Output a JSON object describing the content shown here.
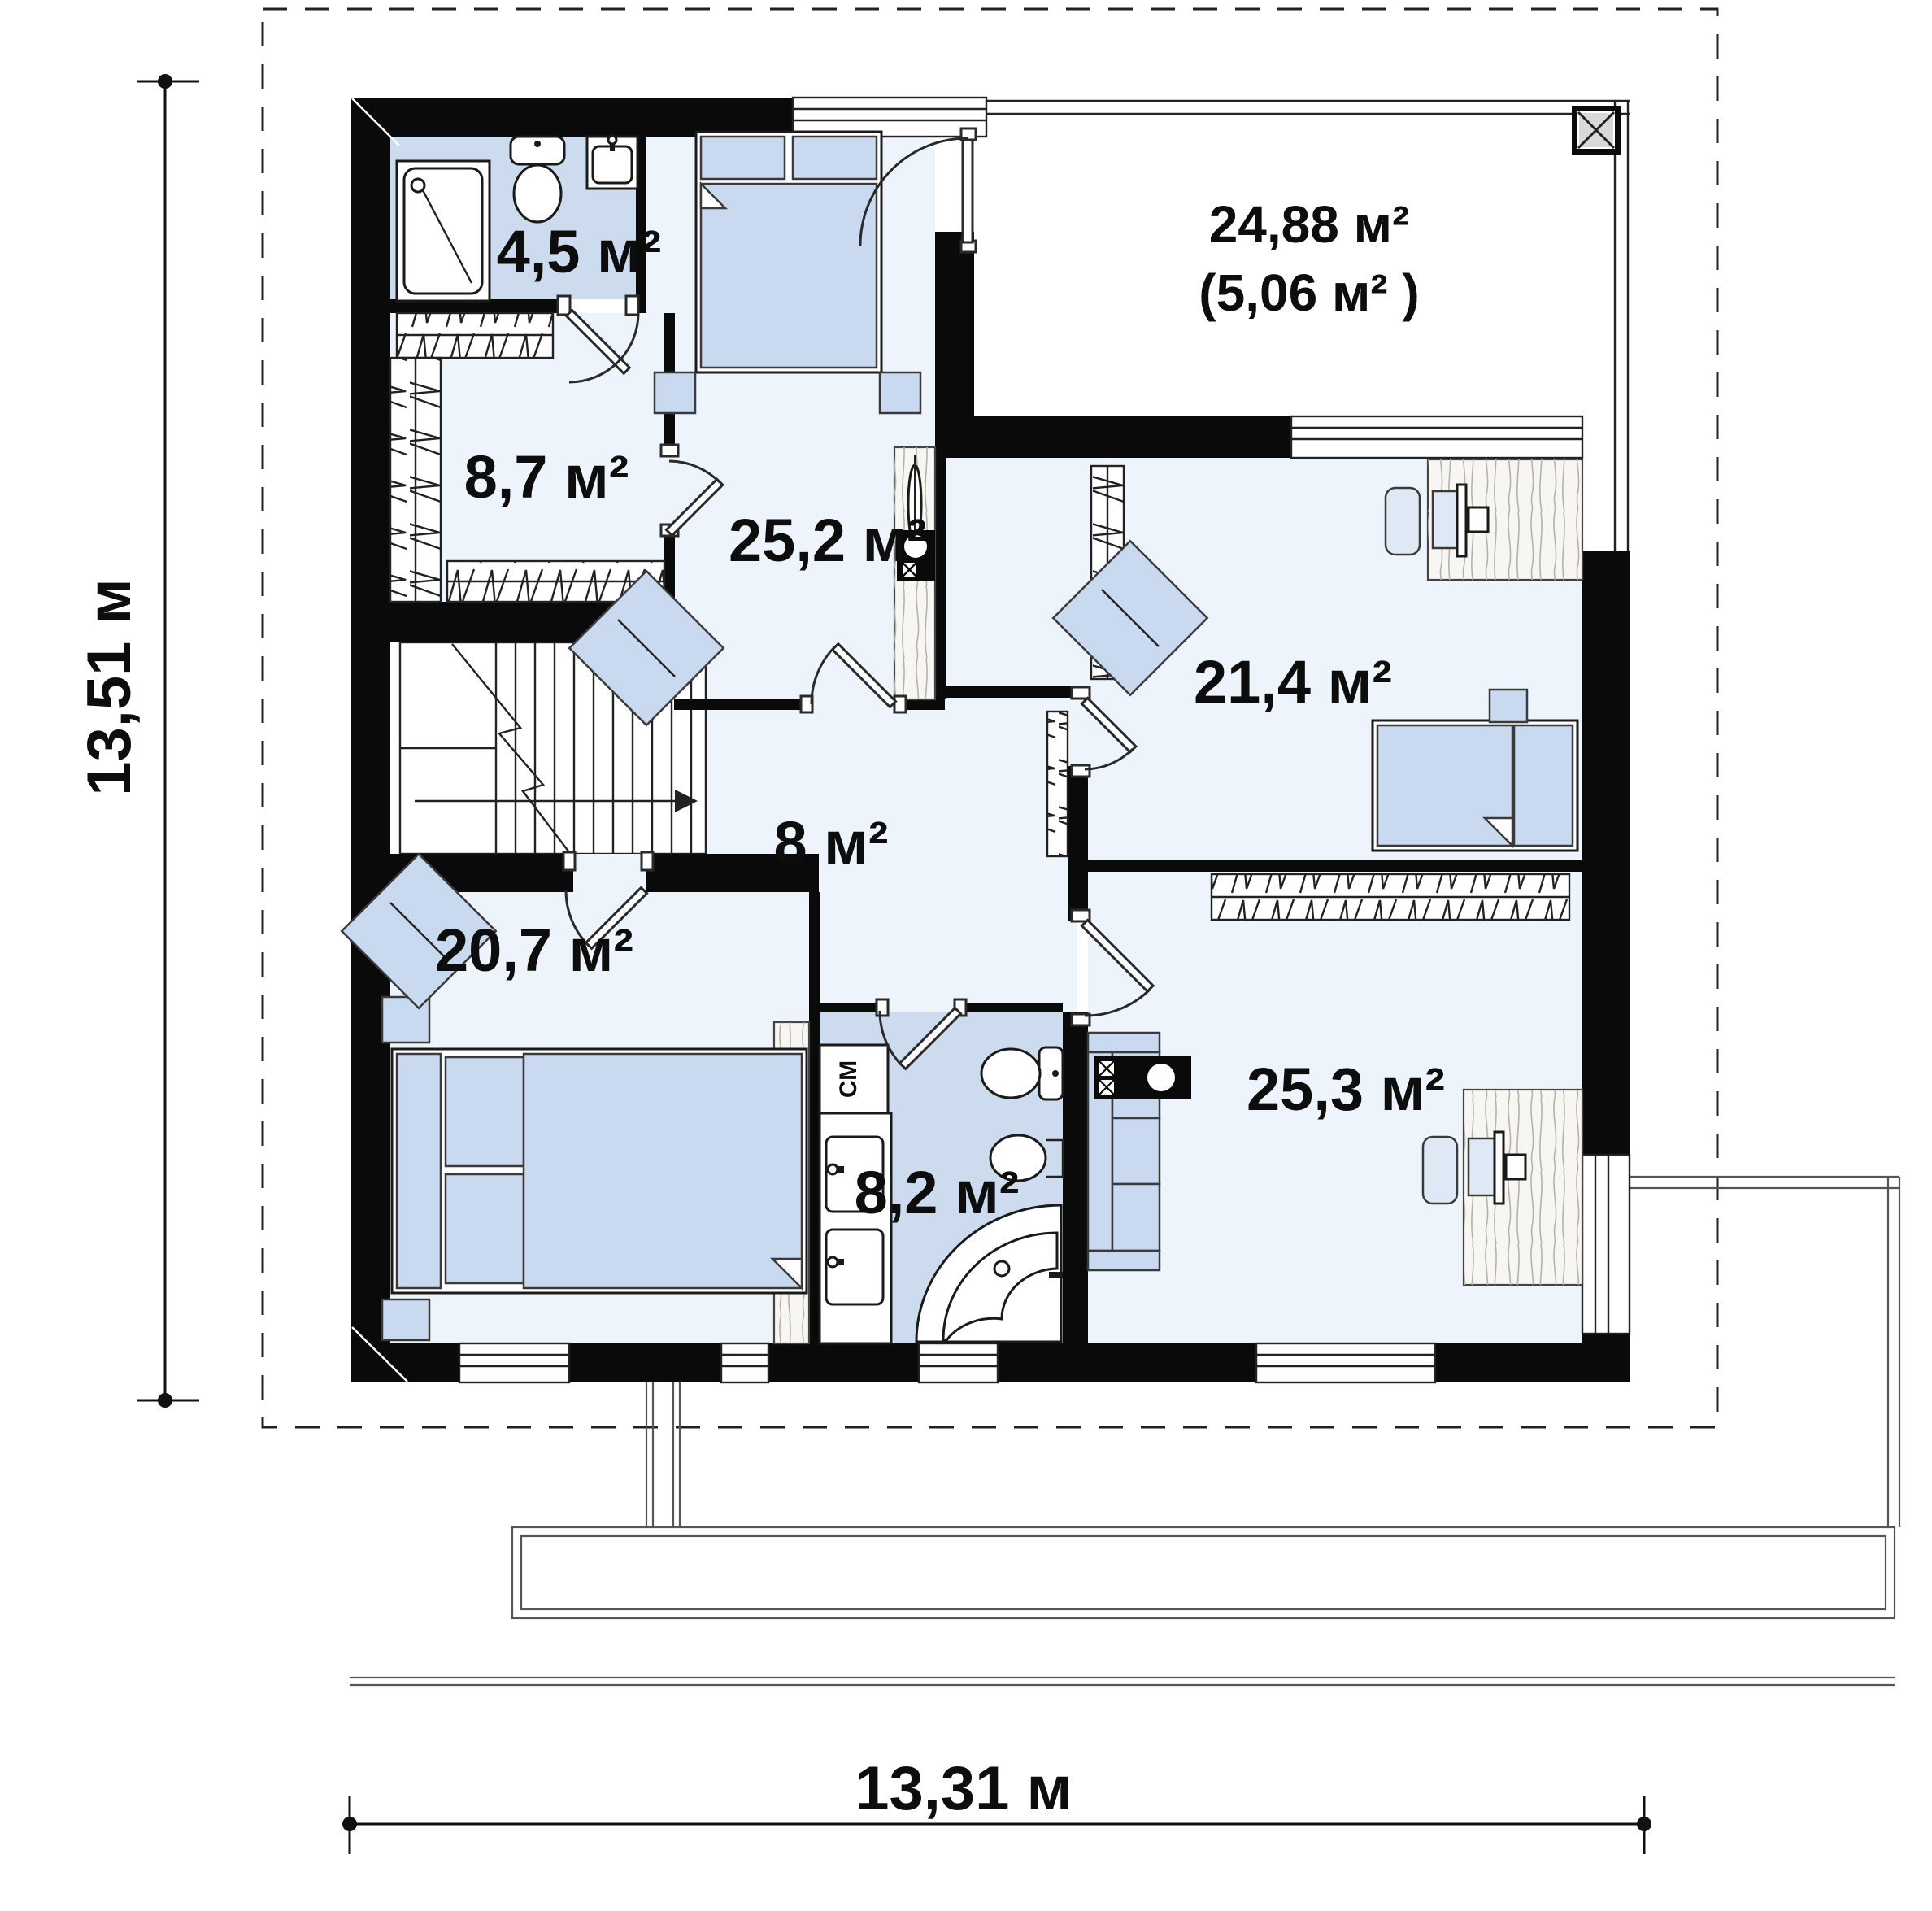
{
  "floor_plan": {
    "title": "second floor plan",
    "dimensions": {
      "vertical": "13,51 м",
      "horizontal": "13,31 м"
    },
    "rooms": [
      {
        "name": "bathroom-top",
        "area": "4,5 м²"
      },
      {
        "name": "wardrobe",
        "area": "8,7 м²"
      },
      {
        "name": "bedroom-top",
        "area": "25,2 м²"
      },
      {
        "name": "terrace",
        "area": "24,88 м²",
        "area_secondary": "(5,06 м² )"
      },
      {
        "name": "bedroom-right",
        "area": "21,4 м²"
      },
      {
        "name": "hallway",
        "area": "8 м²"
      },
      {
        "name": "bedroom-left",
        "area": "20,7 м²"
      },
      {
        "name": "bathroom-bottom",
        "area": "8,2 м²"
      },
      {
        "name": "bedroom-bottom-right",
        "area": "25,3 м²"
      }
    ],
    "labels": {
      "washing_machine": "СМ"
    },
    "colors": {
      "wall": "#0a0a0a",
      "room_fill": "#edf4fb",
      "wet_room_fill": "#ccdbed",
      "furniture_fill": "#c9d9ef",
      "wood_fill": "#f8f6f2",
      "background": "#ffffff"
    }
  }
}
